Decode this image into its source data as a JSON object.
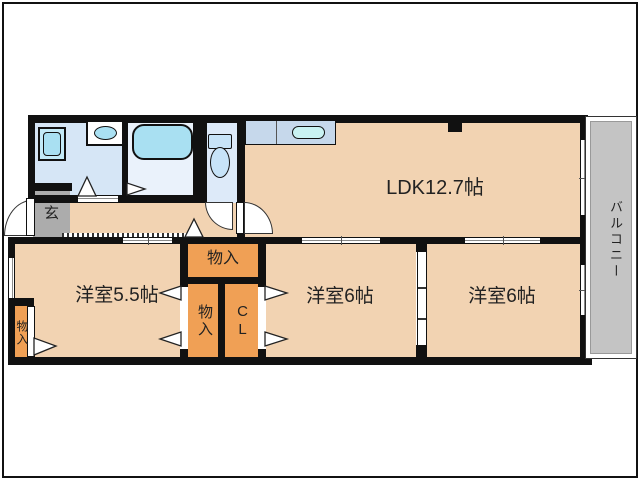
{
  "floorplan": {
    "ldk": {
      "label": "LDK12.7帖"
    },
    "bedroom_left": {
      "label": "洋室5.5帖"
    },
    "bedroom_mid": {
      "label": "洋室6帖"
    },
    "bedroom_right": {
      "label": "洋室6帖"
    },
    "entrance": {
      "label": "玄"
    },
    "balcony": {
      "label": "バルコニー"
    },
    "storage_hall": {
      "label": "物入"
    },
    "storage_mid": {
      "label": "物入"
    },
    "storage_left": {
      "label": "物入"
    },
    "closet": {
      "label": "CL"
    },
    "colors": {
      "wall": "#111111",
      "floor": "#F2D3B2",
      "storage": "#F0A055",
      "washroom": "#D6E6F6",
      "bathroom": "#EAF2FB",
      "toilet_room": "#DDEAF9",
      "fixture_cyan": "#A9E0F2",
      "fixture_light": "#C7E3F8",
      "counter": "#C6D8EB",
      "counter_sink": "#C9F2F2",
      "genkan_gray": "#ACACAC",
      "balcony_gray": "#C4C4C4"
    }
  }
}
